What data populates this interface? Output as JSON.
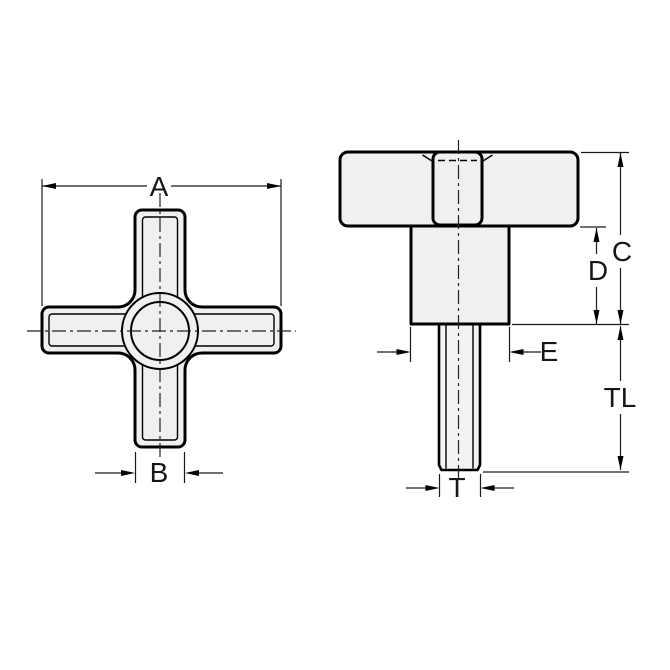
{
  "drawing": {
    "background": "#ffffff",
    "line_color": "#000000",
    "part_fill": "#f0f0f0",
    "label_color": "#16161e",
    "labels": {
      "width_across": "A",
      "arm_width": "B",
      "head_height": "C",
      "hub_height": "D",
      "hub_diameter": "E",
      "thread_length": "TL",
      "thread_diameter": "T"
    }
  }
}
